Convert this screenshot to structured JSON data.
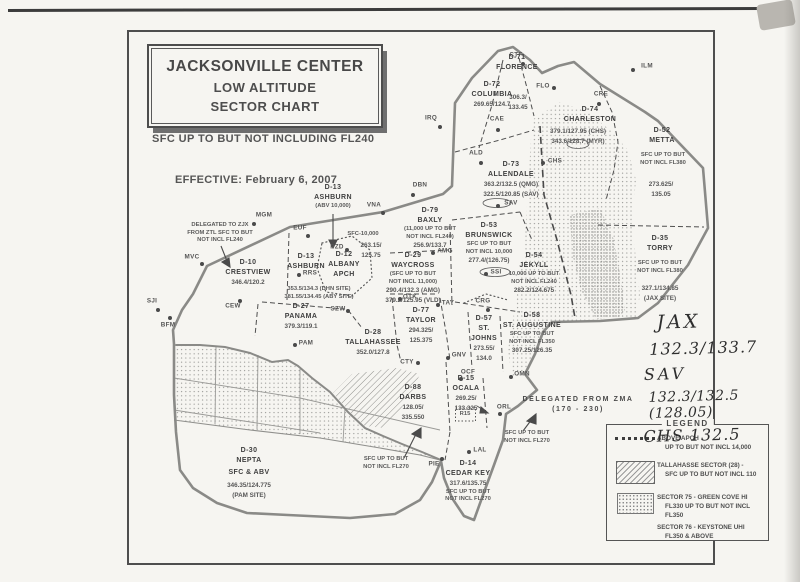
{
  "page": {
    "title_box": {
      "line1": "JACKSONVILLE CENTER",
      "line2": "LOW ALTITUDE",
      "line3": "SECTOR CHART"
    },
    "subtitle": "SFC UP TO BUT NOT INCLUDING FL240",
    "effective": "EFFECTIVE:  February 6, 2007"
  },
  "handwriting": {
    "lines": [
      "JAX",
      "132.3/133.7",
      "SAV",
      "132.3/132.5 (128.05)",
      "CHS  132.5"
    ]
  },
  "legend": {
    "title": "LEGEND",
    "items": [
      {
        "swatch": "dotted-line",
        "line1": "ABOVE APCH",
        "line2": "UP TO BUT NOT INCL 14,000"
      },
      {
        "swatch": "hatch",
        "line1": "TALLAHASSE SECTOR (28) -",
        "line2": "SFC UP TO BUT NOT INCL 110"
      },
      {
        "swatch": "stipple",
        "line1": "SECTOR 75 - GREEN COVE HI",
        "line2": "FL330 UP TO BUT NOT INCL FL350",
        "line3": "SECTOR 76 - KEYSTONE UHI",
        "line4": "FL350 & ABOVE"
      }
    ]
  },
  "map": {
    "labels": [
      {
        "id": "d71-florence",
        "x": 517,
        "y": 53,
        "lines": [
          [
            "D-71",
            "n"
          ],
          [
            "FLORENCE",
            "n"
          ]
        ]
      },
      {
        "id": "d71-freq",
        "x": 518,
        "y": 93,
        "lines": [
          [
            "306.3/",
            "f"
          ],
          [
            "133.45",
            "f"
          ]
        ]
      },
      {
        "id": "d72-columbia",
        "x": 492,
        "y": 80,
        "lines": [
          [
            "D-72",
            "n"
          ],
          [
            "COLUMBIA",
            "n"
          ],
          [
            "269.65/124.7",
            "f"
          ]
        ]
      },
      {
        "id": "d74-charleston",
        "x": 590,
        "y": 105,
        "lines": [
          [
            "D-74",
            "n"
          ],
          [
            "CHARLESTON",
            "n"
          ]
        ]
      },
      {
        "id": "d74-freq",
        "x": 578,
        "y": 127,
        "lines": [
          [
            "379.1/127.95 (CHS)",
            "f"
          ],
          [
            "343.6/128.7 (MYR)",
            "f"
          ]
        ]
      },
      {
        "id": "d52-metta",
        "x": 662,
        "y": 126,
        "lines": [
          [
            "D-52",
            "n"
          ],
          [
            "METTA",
            "n"
          ]
        ]
      },
      {
        "id": "d52-alt",
        "x": 663,
        "y": 152,
        "lines": [
          [
            "SFC UP TO BUT",
            "a"
          ],
          [
            "NOT INCL FL380",
            "a"
          ]
        ]
      },
      {
        "id": "d52-freq",
        "x": 661,
        "y": 180,
        "lines": [
          [
            "273.625/",
            "f"
          ],
          [
            "135.05",
            "f"
          ]
        ]
      },
      {
        "id": "d73-allendale",
        "x": 511,
        "y": 160,
        "lines": [
          [
            "D-73",
            "n"
          ],
          [
            "ALLENDALE",
            "n"
          ],
          [
            "363.2/132.5 (QMG)",
            "f"
          ],
          [
            "322.5/120.85 (SAV)",
            "f"
          ]
        ]
      },
      {
        "id": "d79-baxly",
        "x": 430,
        "y": 206,
        "lines": [
          [
            "D-79",
            "n"
          ],
          [
            "BAXLY",
            "n"
          ],
          [
            "(11,000 UP TO BUT",
            "a"
          ],
          [
            "NOT INCL FL240)",
            "a"
          ],
          [
            "256.9/133.7",
            "f"
          ]
        ]
      },
      {
        "id": "d53-brunswick",
        "x": 489,
        "y": 221,
        "lines": [
          [
            "D-53",
            "n"
          ],
          [
            "BRUNSWICK",
            "n"
          ],
          [
            "SFC UP TO BUT",
            "a"
          ],
          [
            "NOT INCL 10,000",
            "a"
          ],
          [
            "277.4/(126.75)",
            "f"
          ]
        ]
      },
      {
        "id": "d54-jekyll",
        "x": 534,
        "y": 251,
        "lines": [
          [
            "D-54",
            "n"
          ],
          [
            "JEKYLL",
            "n"
          ],
          [
            "10,000 UP TO BUT",
            "a"
          ],
          [
            "NOT INCL FL240",
            "a"
          ],
          [
            "282.2/124.675",
            "f"
          ]
        ]
      },
      {
        "id": "d35-torry",
        "x": 660,
        "y": 234,
        "lines": [
          [
            "D-35",
            "n"
          ],
          [
            "TORRY",
            "n"
          ]
        ]
      },
      {
        "id": "d35-alt",
        "x": 660,
        "y": 260,
        "lines": [
          [
            "SFC UP TO BUT",
            "a"
          ],
          [
            "NOT INCL FL380",
            "a"
          ]
        ]
      },
      {
        "id": "d35-freq",
        "x": 660,
        "y": 284,
        "lines": [
          [
            "327.1/134.85",
            "f"
          ],
          [
            "(JAX SITE)",
            "f"
          ]
        ]
      },
      {
        "id": "d29-waycross",
        "x": 413,
        "y": 251,
        "lines": [
          [
            "D-29",
            "n"
          ],
          [
            "WAYCROSS",
            "n"
          ],
          [
            "(SFC UP TO BUT",
            "a"
          ],
          [
            "NOT INCL 11,000)",
            "a"
          ],
          [
            "290.4/132.3  (AMG)",
            "f"
          ],
          [
            "379.2/125.95 (VLD)",
            "f"
          ]
        ]
      },
      {
        "id": "d13-ashburn-abv",
        "x": 333,
        "y": 183,
        "lines": [
          [
            "D-13",
            "n"
          ],
          [
            "ASHBURN",
            "n"
          ],
          [
            "(ABV 10,000)",
            "a"
          ]
        ]
      },
      {
        "id": "d13-ashburn",
        "x": 306,
        "y": 252,
        "lines": [
          [
            "D-13",
            "n"
          ],
          [
            "ASHBURN",
            "n"
          ]
        ]
      },
      {
        "id": "d13-freq",
        "x": 319,
        "y": 286,
        "lines": [
          [
            "353.5/134.3  (DHN SITE)",
            "a"
          ],
          [
            "381.55/134.45 (ABY SITE)",
            "a"
          ]
        ]
      },
      {
        "id": "albany-sfc",
        "x": 363,
        "y": 231,
        "lines": [
          [
            "SFC-10,000",
            "a"
          ]
        ]
      },
      {
        "id": "d12-freq",
        "x": 371,
        "y": 241,
        "lines": [
          [
            "263.15/",
            "f"
          ],
          [
            "125.75",
            "f"
          ]
        ]
      },
      {
        "id": "d12-albany",
        "x": 344,
        "y": 250,
        "lines": [
          [
            "D-12",
            "n"
          ],
          [
            "ALBANY",
            "n"
          ],
          [
            "APCH",
            "n"
          ]
        ]
      },
      {
        "id": "d10-crestview",
        "x": 248,
        "y": 258,
        "lines": [
          [
            "D-10",
            "n"
          ],
          [
            "CRESTVIEW",
            "n"
          ],
          [
            "346.4/120.2",
            "f"
          ]
        ]
      },
      {
        "id": "ztl-note",
        "x": 220,
        "y": 222,
        "lines": [
          [
            "DELEGATED TO ZJX",
            "a"
          ],
          [
            "FROM ZTL SFC TO BUT",
            "a"
          ],
          [
            "NOT INCL FL240",
            "a"
          ]
        ]
      },
      {
        "id": "d27-panama",
        "x": 301,
        "y": 302,
        "lines": [
          [
            "D-27",
            "n"
          ],
          [
            "PANAMA",
            "n"
          ],
          [
            "379.3/119.1",
            "f"
          ]
        ]
      },
      {
        "id": "d28-tallahassee",
        "x": 373,
        "y": 328,
        "lines": [
          [
            "D-28",
            "n"
          ],
          [
            "TALLAHASSEE",
            "n"
          ],
          [
            "352.0/127.8",
            "f"
          ]
        ]
      },
      {
        "id": "d77-taylor",
        "x": 421,
        "y": 306,
        "lines": [
          [
            "D-77",
            "n"
          ],
          [
            "TAYLOR",
            "n"
          ],
          [
            "294.325/",
            "f"
          ],
          [
            "125.375",
            "f"
          ]
        ]
      },
      {
        "id": "d57-st-johns",
        "x": 484,
        "y": 314,
        "lines": [
          [
            "D-57",
            "n"
          ],
          [
            "ST.",
            "n"
          ],
          [
            "JOHNS",
            "n"
          ],
          [
            "273.55/",
            "f"
          ],
          [
            "134.0",
            "f"
          ]
        ]
      },
      {
        "id": "d58-st-augustine",
        "x": 532,
        "y": 311,
        "lines": [
          [
            "D-58",
            "n"
          ],
          [
            "ST. AUGUSTINE",
            "n"
          ],
          [
            "SFC UP TO BUT",
            "a"
          ],
          [
            "NOT INCL FL350",
            "a"
          ],
          [
            "307.25/126.35",
            "f"
          ]
        ]
      },
      {
        "id": "zma-note",
        "x": 578,
        "y": 395,
        "lines": [
          [
            "DELEGATED FROM ZMA",
            "d"
          ],
          [
            "(170 - 230)",
            "d"
          ]
        ]
      },
      {
        "id": "d15-ocala",
        "x": 466,
        "y": 374,
        "lines": [
          [
            "D-15",
            "n"
          ],
          [
            "OCALA",
            "n"
          ],
          [
            "269.25/",
            "f"
          ],
          [
            "133.325",
            "f"
          ]
        ]
      },
      {
        "id": "r15",
        "x": 465,
        "y": 411,
        "lines": [
          [
            "R15",
            "a"
          ]
        ]
      },
      {
        "id": "fl270-east",
        "x": 527,
        "y": 430,
        "lines": [
          [
            "SFC UP TO BUT",
            "a"
          ],
          [
            "NOT INCL FL270",
            "a"
          ]
        ]
      },
      {
        "id": "d14-cedar-key",
        "x": 468,
        "y": 459,
        "lines": [
          [
            "D-14",
            "n"
          ],
          [
            "CEDAR KEY",
            "n"
          ],
          [
            "317.6/135.75",
            "f"
          ],
          [
            "SFC UP TO BUT",
            "a"
          ],
          [
            "NOT INCL FL270",
            "a"
          ]
        ]
      },
      {
        "id": "d88-darbs",
        "x": 413,
        "y": 383,
        "lines": [
          [
            "D-88",
            "n"
          ],
          [
            "DARBS",
            "n"
          ],
          [
            "128.05/",
            "f"
          ],
          [
            "335.550",
            "f"
          ]
        ]
      },
      {
        "id": "fl270-west",
        "x": 386,
        "y": 456,
        "lines": [
          [
            "SFC UP TO BUT",
            "a"
          ],
          [
            "NOT INCL FL270",
            "a"
          ]
        ]
      },
      {
        "id": "d30-nepta",
        "x": 249,
        "y": 446,
        "lines": [
          [
            "D-30",
            "n"
          ],
          [
            "NEPTA",
            "n"
          ]
        ]
      },
      {
        "id": "d30-alt",
        "x": 249,
        "y": 468,
        "lines": [
          [
            "SFC & ABV",
            "n"
          ]
        ]
      },
      {
        "id": "d30-freq",
        "x": 249,
        "y": 481,
        "lines": [
          [
            "346.35/124.775",
            "f"
          ],
          [
            "(PAM SITE)",
            "f"
          ]
        ]
      }
    ],
    "fixes": [
      {
        "id": "CTF",
        "x": 523,
        "y": 64,
        "lx": 516,
        "ly": 55
      },
      {
        "id": "FLO",
        "x": 554,
        "y": 88,
        "lx": 543,
        "ly": 86
      },
      {
        "id": "CAE",
        "x": 498,
        "y": 130,
        "lx": 497,
        "ly": 119
      },
      {
        "id": "IRQ",
        "x": 440,
        "y": 127,
        "lx": 431,
        "ly": 118
      },
      {
        "id": "ILM",
        "x": 633,
        "y": 70,
        "lx": 647,
        "ly": 66
      },
      {
        "id": "CRE",
        "x": 599,
        "y": 104,
        "lx": 601,
        "ly": 94
      },
      {
        "id": "CHS",
        "x": 543,
        "y": 163,
        "lx": 555,
        "ly": 161
      },
      {
        "id": "ALD",
        "x": 481,
        "y": 163,
        "lx": 476,
        "ly": 153
      },
      {
        "id": "DBN",
        "x": 413,
        "y": 195,
        "lx": 420,
        "ly": 185
      },
      {
        "id": "SAV",
        "x": 498,
        "y": 206,
        "lx": 511,
        "ly": 203
      },
      {
        "id": "MGM",
        "x": 254,
        "y": 224,
        "lx": 264,
        "ly": 215
      },
      {
        "id": "EUF",
        "x": 308,
        "y": 236,
        "lx": 300,
        "ly": 228
      },
      {
        "id": "MVC",
        "x": 202,
        "y": 264,
        "lx": 192,
        "ly": 257
      },
      {
        "id": "SJI",
        "x": 158,
        "y": 310,
        "lx": 152,
        "ly": 301
      },
      {
        "id": "BFM",
        "x": 170,
        "y": 318,
        "lx": 168,
        "ly": 325
      },
      {
        "id": "CEW",
        "x": 240,
        "y": 301,
        "lx": 233,
        "ly": 306
      },
      {
        "id": "PAM",
        "x": 295,
        "y": 345,
        "lx": 306,
        "ly": 343
      },
      {
        "id": "VNA",
        "x": 383,
        "y": 213,
        "lx": 374,
        "ly": 205
      },
      {
        "id": "PZD",
        "x": 347,
        "y": 250,
        "lx": 337,
        "ly": 247
      },
      {
        "id": "RRS",
        "x": 299,
        "y": 275,
        "lx": 310,
        "ly": 273
      },
      {
        "id": "OTK",
        "x": 400,
        "y": 299,
        "lx": 410,
        "ly": 297
      },
      {
        "id": "AMG",
        "x": 433,
        "y": 253,
        "lx": 445,
        "ly": 251
      },
      {
        "id": "SZW",
        "x": 348,
        "y": 311,
        "lx": 338,
        "ly": 309
      },
      {
        "id": "TAY",
        "x": 438,
        "y": 305,
        "lx": 448,
        "ly": 303
      },
      {
        "id": "CRG",
        "x": 488,
        "y": 310,
        "lx": 483,
        "ly": 301
      },
      {
        "id": "SSI",
        "x": 486,
        "y": 274,
        "lx": 496,
        "ly": 272
      },
      {
        "id": "GNV",
        "x": 448,
        "y": 358,
        "lx": 459,
        "ly": 355
      },
      {
        "id": "CTY",
        "x": 418,
        "y": 363,
        "lx": 407,
        "ly": 362
      },
      {
        "id": "OCF",
        "x": 461,
        "y": 379,
        "lx": 468,
        "ly": 372
      },
      {
        "id": "ORL",
        "x": 500,
        "y": 414,
        "lx": 504,
        "ly": 407
      },
      {
        "id": "LAL",
        "x": 469,
        "y": 452,
        "lx": 480,
        "ly": 450
      },
      {
        "id": "OMN",
        "x": 511,
        "y": 377,
        "lx": 522,
        "ly": 374
      },
      {
        "id": "PIE",
        "x": 442,
        "y": 459,
        "lx": 434,
        "ly": 464
      }
    ]
  }
}
